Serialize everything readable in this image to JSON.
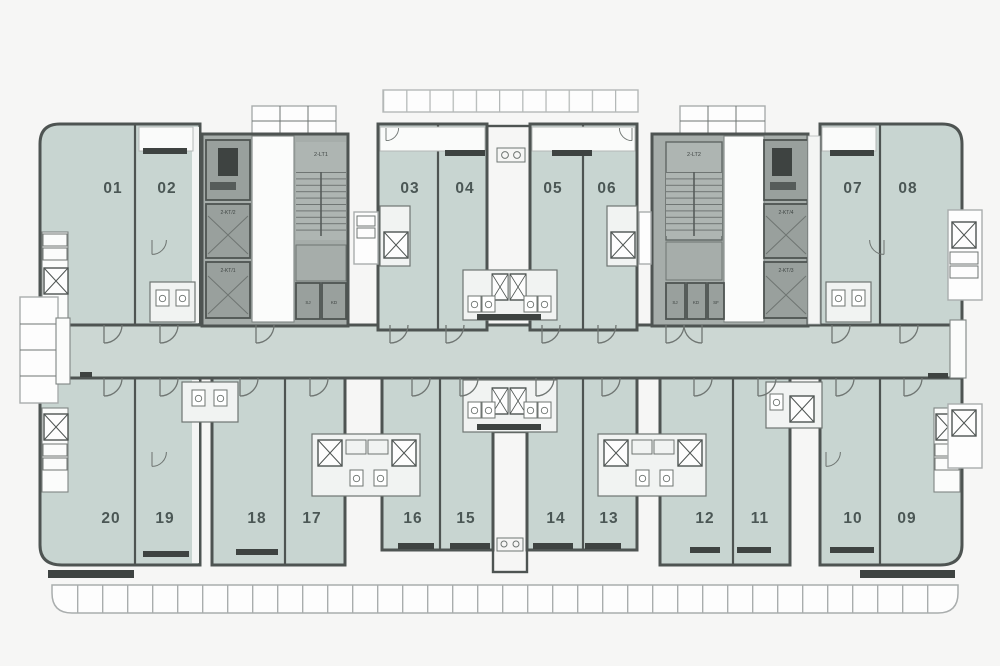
{
  "plan_type": "residential-floor-plan",
  "units": {
    "top": [
      "01",
      "02",
      "03",
      "04",
      "05",
      "06",
      "07",
      "08"
    ],
    "bottom": [
      "20",
      "19",
      "18",
      "17",
      "16",
      "15",
      "14",
      "13",
      "12",
      "11",
      "10",
      "09"
    ]
  },
  "cores": {
    "left": {
      "stair_label": "2-LT1",
      "elevator_labels": [
        "2-KT/2",
        "2-KT/1"
      ],
      "room_labels": [
        "SJ",
        "KD"
      ]
    },
    "right": {
      "stair_label": "2-LT2",
      "elevator_labels": [
        "2-KT/4",
        "2-KT/3"
      ],
      "room_labels": [
        "SJ",
        "KD",
        "SF"
      ]
    }
  },
  "colors": {
    "background": "#f6f6f5",
    "unit_fill": "#c8d5d1",
    "corridor_fill": "#ccd7d3",
    "core_fill": "#a6adaa",
    "elevator_fill": "#99a09d",
    "wall": "#4e5452",
    "label_text": "#4b5755"
  }
}
